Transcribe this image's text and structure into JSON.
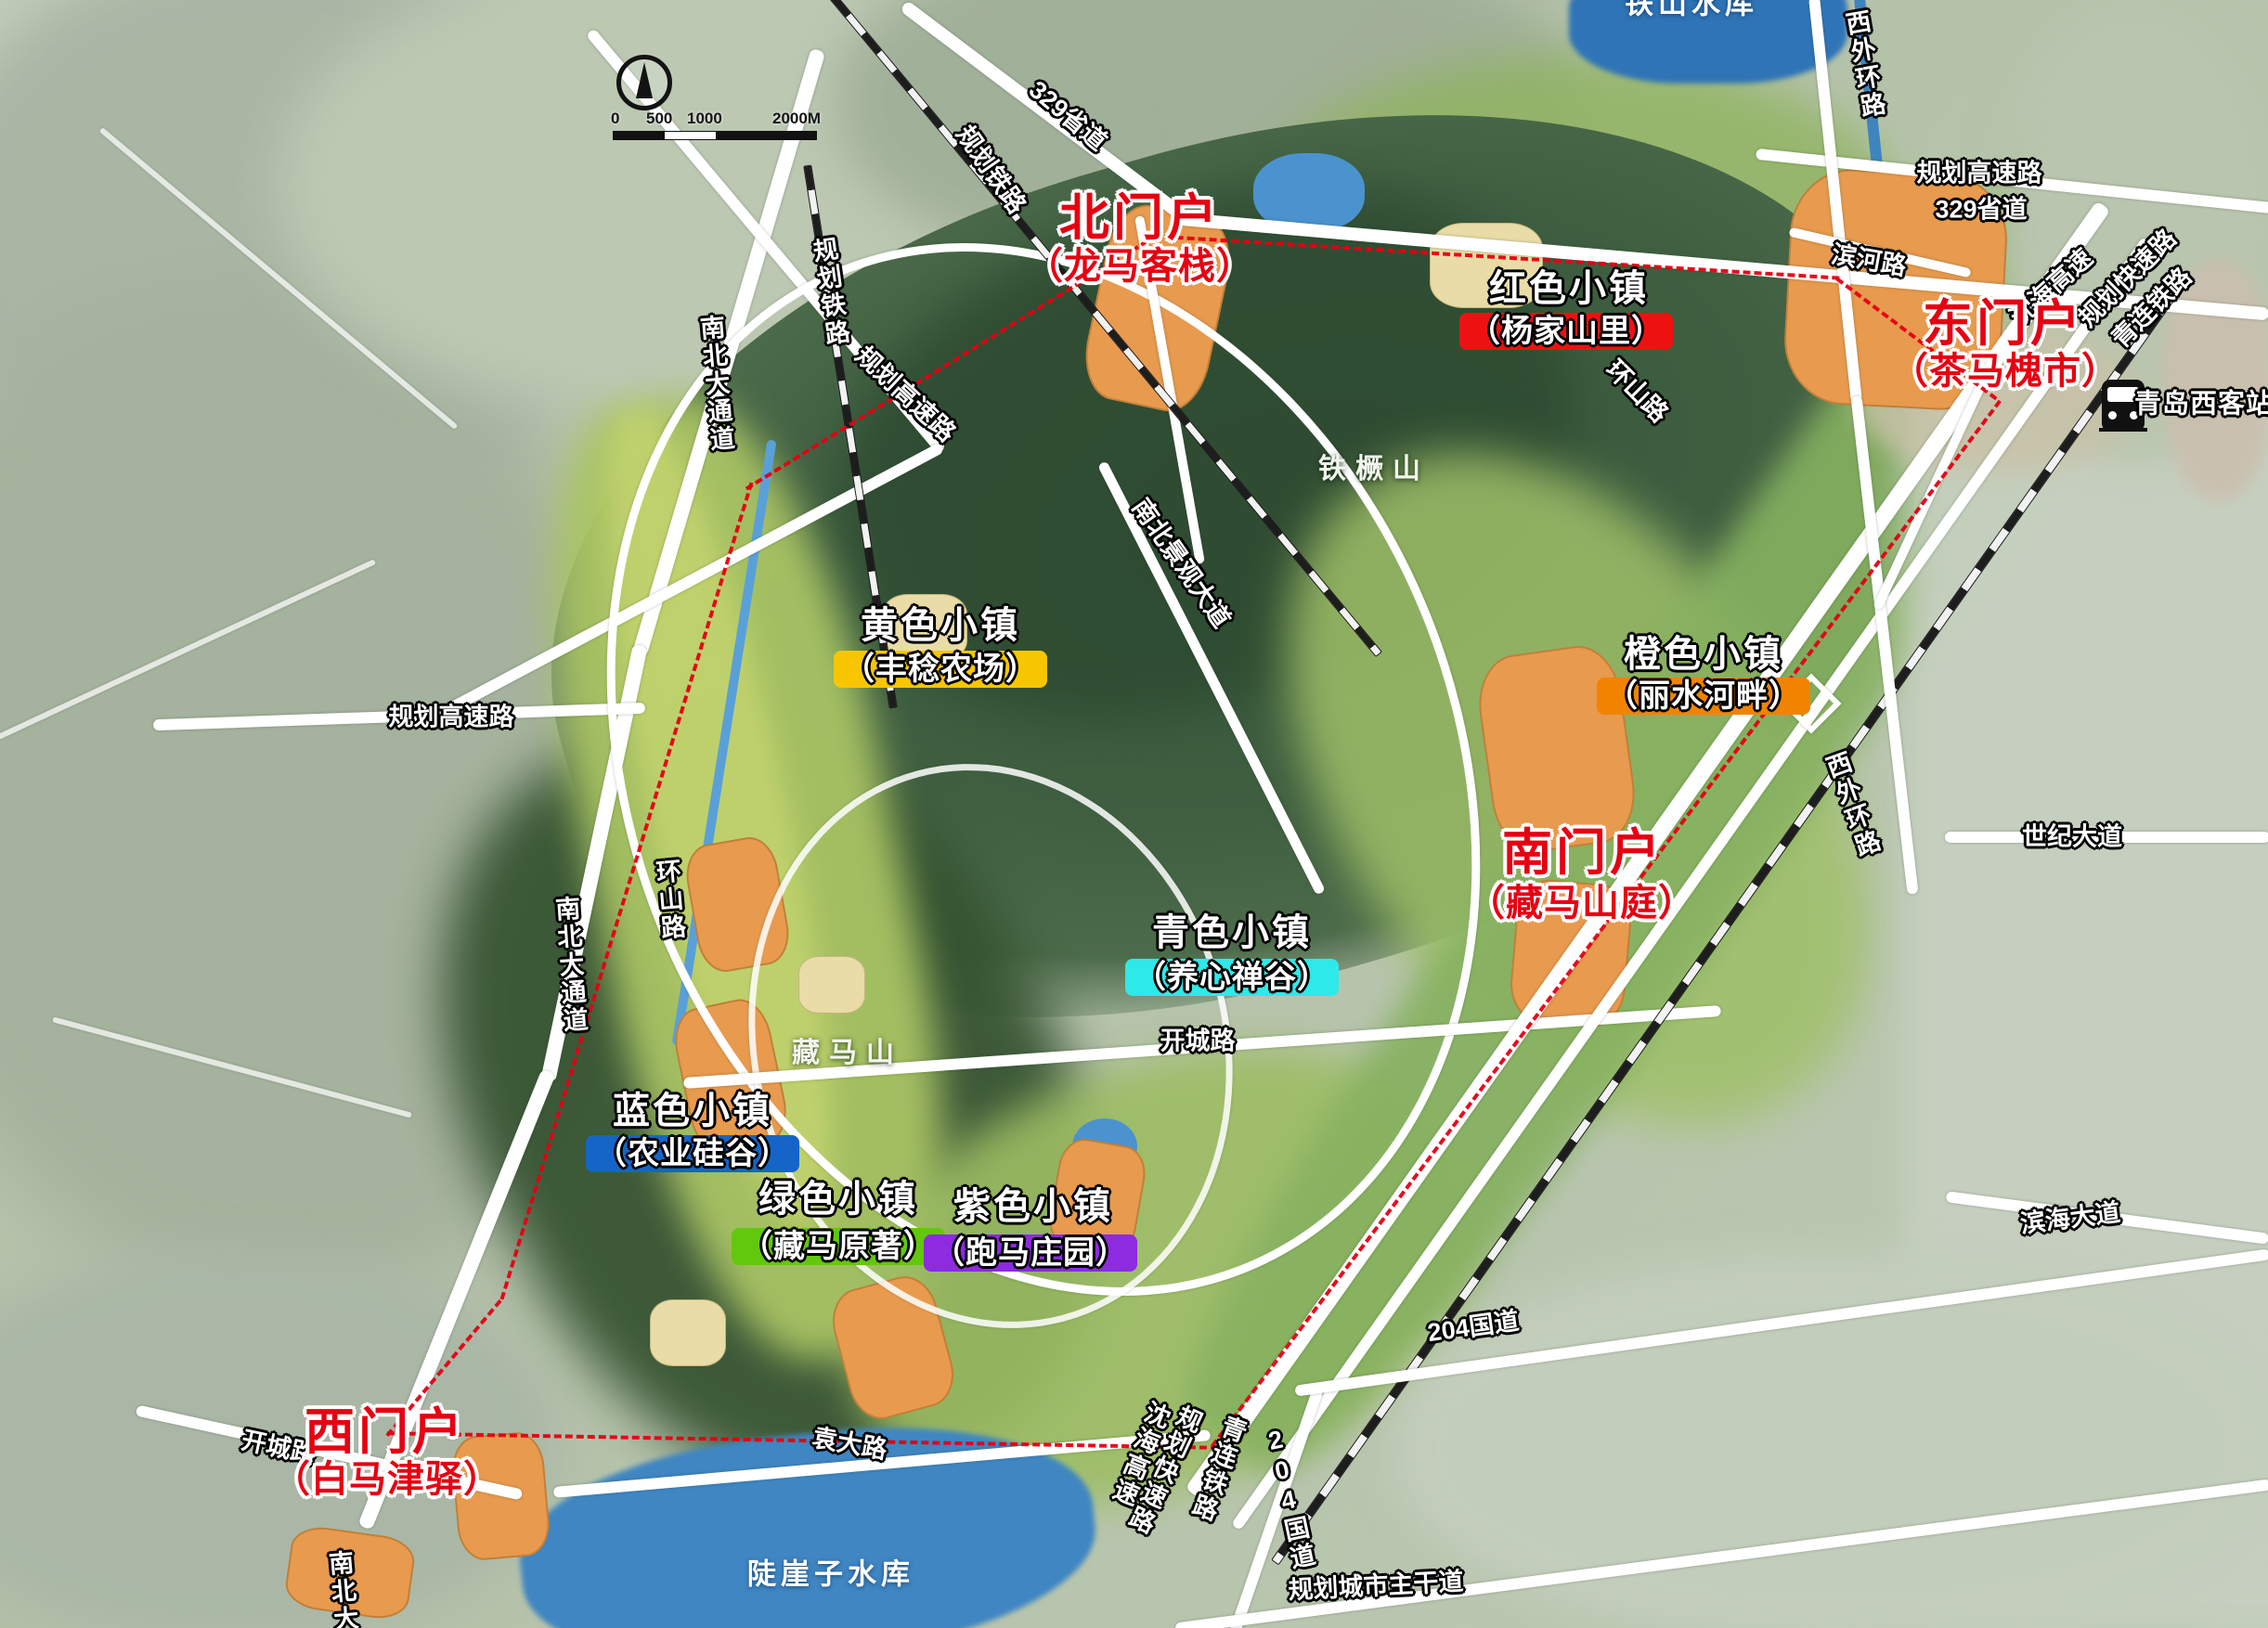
{
  "palette": {
    "gate_text": "#e60012",
    "boundary": "#e60012",
    "road_white": "#ffffff",
    "rail_dark": "#1d1d1d",
    "water_blue": "#3f86c2",
    "park_dark_green": "#37553a",
    "valley_green": "#a9c464",
    "orange_patch": "#e89a4e"
  },
  "gates": [
    {
      "id": "north",
      "title": "北门户",
      "subtitle": "（龙马客栈）"
    },
    {
      "id": "east",
      "title": "东门户",
      "subtitle": "（茶马槐市）"
    },
    {
      "id": "south",
      "title": "南门户",
      "subtitle": "（藏马山庭）"
    },
    {
      "id": "west",
      "title": "西门户",
      "subtitle": "（白马津驿）"
    }
  ],
  "towns": [
    {
      "id": "red",
      "title": "红色小镇",
      "subtitle": "（杨家山里）",
      "badge_color": "#ee1111"
    },
    {
      "id": "yellow",
      "title": "黄色小镇",
      "subtitle": "（丰稔农场）",
      "badge_color": "#f7c600"
    },
    {
      "id": "orange",
      "title": "橙色小镇",
      "subtitle": "（丽水河畔）",
      "badge_color": "#f28300"
    },
    {
      "id": "cyan",
      "title": "青色小镇",
      "subtitle": "（养心禅谷）",
      "badge_color": "#2ee9e9"
    },
    {
      "id": "blue",
      "title": "蓝色小镇",
      "subtitle": "（农业硅谷）",
      "badge_color": "#1565c8"
    },
    {
      "id": "green",
      "title": "绿色小镇",
      "subtitle": "（藏马原著）",
      "badge_color": "#62c80c"
    },
    {
      "id": "purple",
      "title": "紫色小镇",
      "subtitle": "（跑马庄园）",
      "badge_color": "#8d2be0"
    }
  ],
  "roads": [
    {
      "label": "329省道"
    },
    {
      "label": "规划铁路"
    },
    {
      "label": "规划铁路"
    },
    {
      "label": "规划高速路"
    },
    {
      "label": "南北大通道"
    },
    {
      "label": "规划高速路"
    },
    {
      "label": "环山路"
    },
    {
      "label": "南北大通道"
    },
    {
      "label": "南北景观大道"
    },
    {
      "label": "环山路"
    },
    {
      "label": "开城路"
    },
    {
      "label": "开城路"
    },
    {
      "label": "袁大路"
    },
    {
      "label": "规划高速路"
    },
    {
      "label": "329省道"
    },
    {
      "label": "滨河路"
    },
    {
      "label": "西外环路"
    },
    {
      "label": "西外环路"
    },
    {
      "label": "沈海高速"
    },
    {
      "label": "规划快速路"
    },
    {
      "label": "青连铁路"
    },
    {
      "label": "世纪大道"
    },
    {
      "label": "滨海大道"
    },
    {
      "label": "沈海高速"
    },
    {
      "label": "规划快速路"
    },
    {
      "label": "青连铁路"
    },
    {
      "label": "204国道"
    },
    {
      "label": "204国道"
    },
    {
      "label": "规划城市主干道"
    },
    {
      "label": "南北大通道"
    }
  ],
  "mountains": [
    {
      "label": "铁橛山"
    },
    {
      "label": "藏马山"
    }
  ],
  "waters": [
    {
      "label": "陡崖子水库"
    },
    {
      "label": "铁山水库"
    }
  ],
  "station": {
    "label": "青岛西客站"
  },
  "scale_bar": {
    "ticks": [
      "0",
      "500",
      "1000",
      "2000M"
    ]
  }
}
